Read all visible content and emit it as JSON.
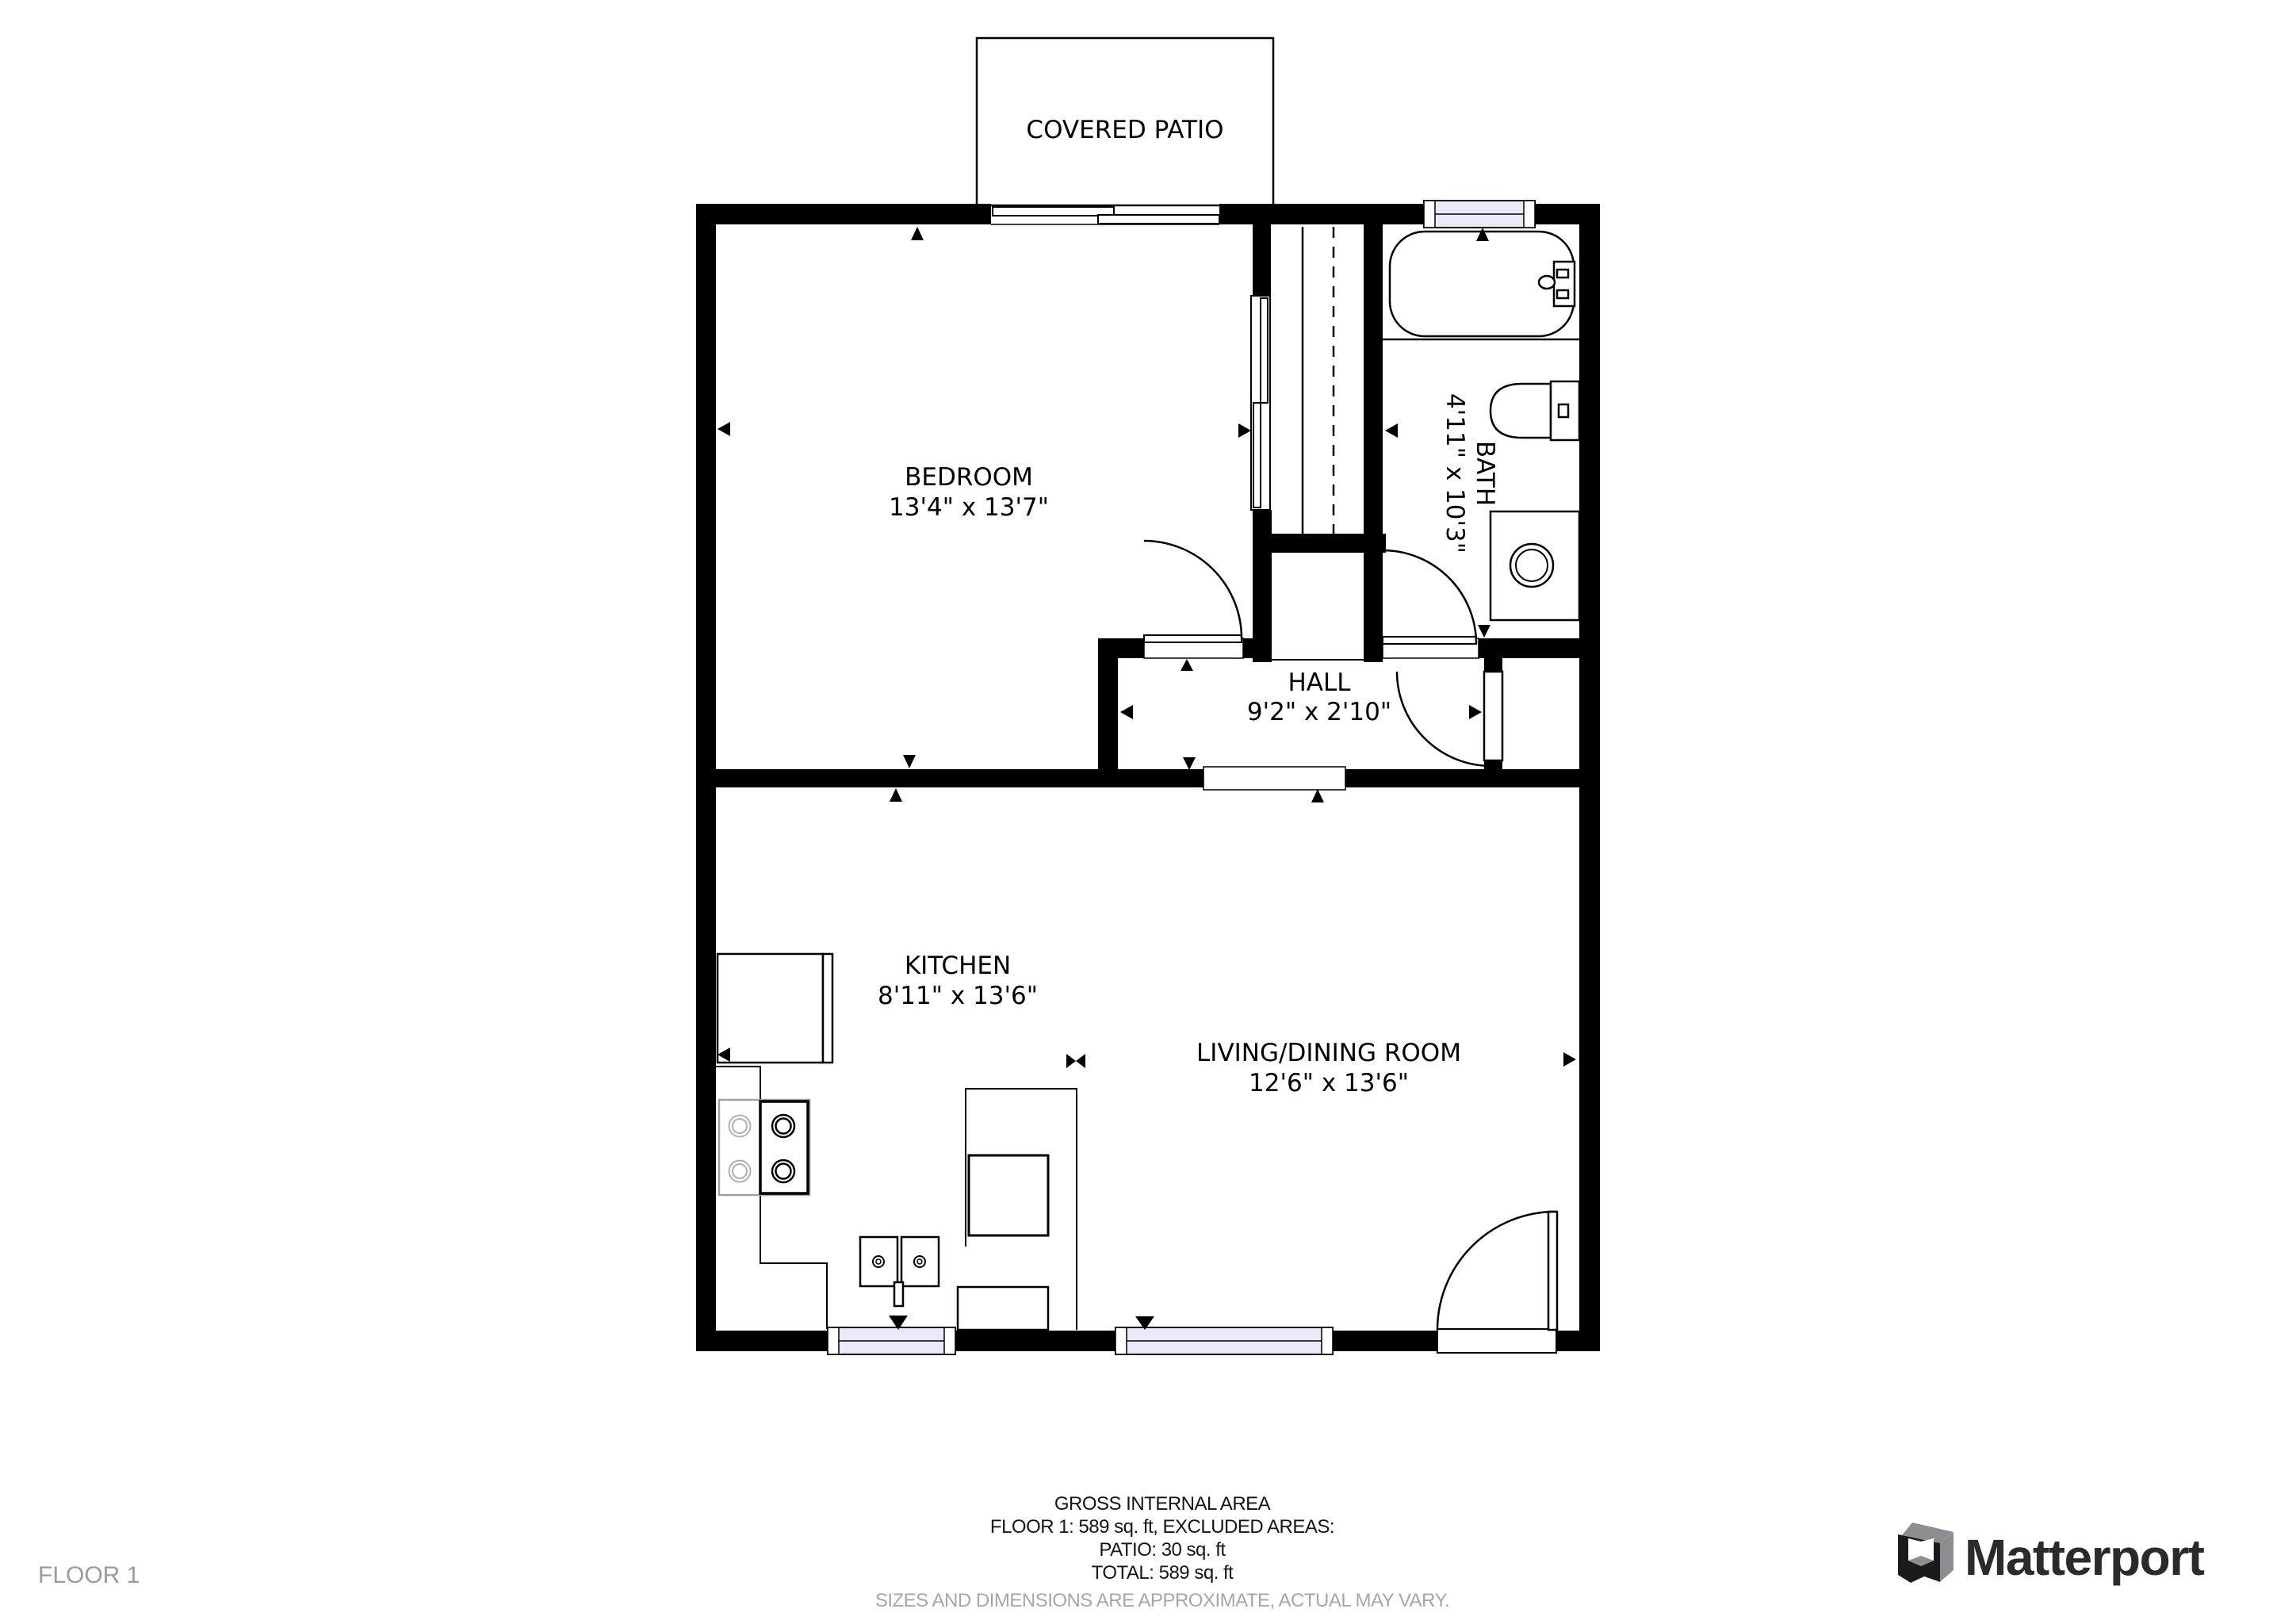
{
  "plan": {
    "patio": {
      "label": "COVERED PATIO"
    },
    "rooms": {
      "bedroom": {
        "name": "BEDROOM",
        "dims": "13'4\" x 13'7\""
      },
      "bath": {
        "name": "BATH",
        "dims": "4'11\" x 10'3\""
      },
      "hall": {
        "name": "HALL",
        "dims": "9'2\" x 2'10\""
      },
      "kitchen": {
        "name": "KITCHEN",
        "dims": "8'11\" x 13'6\""
      },
      "living": {
        "name": "LIVING/DINING ROOM",
        "dims": "12'6\" x 13'6\""
      }
    }
  },
  "footer": {
    "floor_label": "FLOOR 1",
    "summary": [
      "GROSS INTERNAL AREA",
      "FLOOR 1: 589 sq. ft, EXCLUDED AREAS:",
      "PATIO: 30 sq. ft",
      "TOTAL: 589 sq. ft"
    ],
    "disclaimer": "SIZES AND DIMENSIONS ARE APPROXIMATE, ACTUAL MAY VARY.",
    "brand": "Matterport"
  },
  "colors": {
    "wall": "#000000",
    "window_fill": "#e9e9f8",
    "muted": "#9b9b9b",
    "brand": "#2b2b2e",
    "logo_gray": "#8e8e92"
  }
}
